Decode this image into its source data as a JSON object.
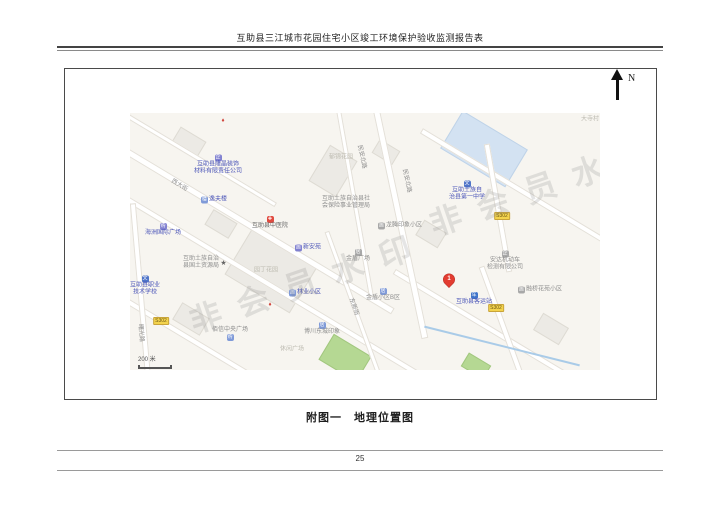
{
  "page": {
    "header_title": "互助县三江城市花园住宅小区竣工环境保护验收监测报告表",
    "caption": "附图一　地理位置图",
    "page_number": "25"
  },
  "compass": {
    "label": "N"
  },
  "map": {
    "watermark_text": "非会员水印",
    "watermarks": [
      {
        "x": 60,
        "y": 185,
        "rot": -19
      },
      {
        "x": 300,
        "y": 88,
        "rot": -19
      }
    ],
    "scale_label": "200 米",
    "scale": {
      "x": 8,
      "y": 244
    },
    "colors": {
      "map_bg": "#f7f5f0",
      "poi_blue": "#4b55b8",
      "label_gray": "#8e8e8e",
      "label_light": "#bdbbb1",
      "badge_yellow": "#f3d34d",
      "marker_red": "#e23c31",
      "school_fill": "#d3e2f2",
      "park_fill": "#b5d893"
    },
    "marker": {
      "number": "1",
      "x": 319,
      "y": 172
    },
    "badges": [
      {
        "text": "S302",
        "x": 31,
        "y": 208
      },
      {
        "text": "S302",
        "x": 372,
        "y": 103
      },
      {
        "text": "S302",
        "x": 366,
        "y": 195
      }
    ],
    "roads": [
      {
        "x": 100,
        "y": 100,
        "len": 380,
        "w": 7,
        "a": 31
      },
      {
        "x": 170,
        "y": 190,
        "len": 460,
        "w": 6,
        "a": 31
      },
      {
        "x": 150,
        "y": 280,
        "len": 380,
        "w": 6,
        "a": 31
      },
      {
        "x": 420,
        "y": 95,
        "len": 300,
        "w": 6,
        "a": 31
      },
      {
        "x": 380,
        "y": 228,
        "len": 270,
        "w": 6,
        "a": 31
      },
      {
        "x": 60,
        "y": 40,
        "len": 200,
        "w": 5,
        "a": 31
      },
      {
        "x": 270,
        "y": 110,
        "len": 235,
        "w": 7,
        "a": 78
      },
      {
        "x": 225,
        "y": 90,
        "len": 190,
        "w": 5,
        "a": 80
      },
      {
        "x": 368,
        "y": 95,
        "len": 130,
        "w": 6,
        "a": 80
      },
      {
        "x": 372,
        "y": 210,
        "len": 120,
        "w": 6,
        "a": 70
      },
      {
        "x": 12,
        "y": 195,
        "len": 210,
        "w": 6,
        "a": 85
      },
      {
        "x": 228,
        "y": 205,
        "len": 185,
        "w": 5,
        "a": 70
      }
    ],
    "river": {
      "x": 372,
      "y": 233,
      "len": 160,
      "w": 2,
      "a": 14
    },
    "buildings": [
      {
        "x": 141,
        "y": 155,
        "w": 74,
        "h": 56,
        "a": 31,
        "type": "block"
      },
      {
        "x": 202,
        "y": 57,
        "w": 30,
        "h": 40,
        "a": 31,
        "type": "block"
      },
      {
        "x": 58,
        "y": 28,
        "w": 28,
        "h": 16,
        "a": 31,
        "type": "block"
      },
      {
        "x": 255,
        "y": 38,
        "w": 22,
        "h": 14,
        "a": 31,
        "type": "block"
      },
      {
        "x": 60,
        "y": 205,
        "w": 30,
        "h": 18,
        "a": 31,
        "type": "block"
      },
      {
        "x": 300,
        "y": 120,
        "w": 24,
        "h": 16,
        "a": 31,
        "type": "block"
      },
      {
        "x": 420,
        "y": 215,
        "w": 28,
        "h": 18,
        "a": 31,
        "type": "block"
      },
      {
        "x": 90,
        "y": 110,
        "w": 26,
        "h": 16,
        "a": 31,
        "type": "block"
      },
      {
        "x": 353,
        "y": 35,
        "w": 74,
        "h": 42,
        "a": 31,
        "type": "school"
      },
      {
        "x": 214,
        "y": 244,
        "w": 42,
        "h": 28,
        "a": 31,
        "type": "park"
      },
      {
        "x": 345,
        "y": 252,
        "w": 24,
        "h": 14,
        "a": 31,
        "type": "park"
      }
    ],
    "pois": [
      {
        "name": "label-longjing-company",
        "lines": [
          "互助县隆晶装饰",
          "材料有限责任公司"
        ],
        "x": 88,
        "y": 52,
        "color": "blue",
        "icon": {
          "name": "company-icon",
          "glyph": "企",
          "bg": "#8080d0",
          "pos": "above"
        }
      },
      {
        "name": "label-yifulou",
        "lines": [
          "逸夫楼"
        ],
        "x": 84,
        "y": 87,
        "color": "blue",
        "icon": {
          "name": "building-icon",
          "glyph": "楼",
          "bg": "#7f9ad8",
          "pos": "left"
        }
      },
      {
        "name": "label-haizhou-plaza",
        "lines": [
          "海洲国际广场"
        ],
        "x": 33,
        "y": 117,
        "color": "blue",
        "icon": {
          "name": "shopping-icon",
          "glyph": "购",
          "bg": "#8080d0",
          "pos": "above"
        }
      },
      {
        "name": "label-vocational-school",
        "lines": [
          "互助县职业",
          "技术学校"
        ],
        "x": 15,
        "y": 173,
        "color": "blue",
        "icon": {
          "name": "school-icon",
          "glyph": "文",
          "bg": "#4f74c8",
          "pos": "above"
        }
      },
      {
        "name": "label-tcm-hospital",
        "lines": [
          "互助县中医院"
        ],
        "x": 140,
        "y": 110,
        "color": "dark",
        "icon": {
          "name": "hospital-cross-icon",
          "glyph": "✚",
          "bg": "#e04a3f",
          "pos": "above"
        }
      },
      {
        "name": "label-xinanyuan",
        "lines": [
          "新安苑"
        ],
        "x": 178,
        "y": 135,
        "color": "blue",
        "icon": {
          "name": "residence-icon",
          "glyph": "居",
          "bg": "#8080d0",
          "pos": "left"
        }
      },
      {
        "name": "label-land-resources-bureau",
        "lines": [
          "互助土族自治",
          "县国土资源局"
        ],
        "x": 75,
        "y": 150,
        "color": "gray",
        "icon": {
          "name": "star-icon",
          "glyph": "★",
          "bg": "transparent",
          "fg": "#666666",
          "pos": "right"
        }
      },
      {
        "name": "label-yuanding-garden",
        "lines": [
          "园丁花园"
        ],
        "x": 136,
        "y": 158,
        "color": "light"
      },
      {
        "name": "label-linye-community",
        "lines": [
          "林业小区"
        ],
        "x": 175,
        "y": 180,
        "color": "blue",
        "icon": {
          "name": "residence-icon",
          "glyph": "居",
          "bg": "#7f9ad8",
          "pos": "left"
        }
      },
      {
        "name": "label-social-insurance-bureau",
        "lines": [
          "互助土族自治县社",
          "会保险事业管理局"
        ],
        "x": 216,
        "y": 90,
        "color": "gray"
      },
      {
        "name": "label-no1-middle-school",
        "lines": [
          "互助土族自",
          "治县第一中学"
        ],
        "x": 337,
        "y": 78,
        "color": "blue",
        "icon": {
          "name": "school-icon",
          "glyph": "文",
          "bg": "#4f74c8",
          "pos": "above"
        }
      },
      {
        "name": "label-longteng-community",
        "lines": [
          "龙腾印象小区"
        ],
        "x": 270,
        "y": 113,
        "color": "gray",
        "icon": {
          "name": "residence-icon",
          "glyph": "居",
          "bg": "#a8a8a8",
          "pos": "left"
        }
      },
      {
        "name": "label-anda-vehicle-inspection",
        "lines": [
          "安达机动车",
          "检测有限公司"
        ],
        "x": 375,
        "y": 148,
        "color": "gray",
        "icon": {
          "name": "company-icon",
          "glyph": "企",
          "bg": "#a8a8a8",
          "pos": "above"
        }
      },
      {
        "name": "label-bus-station",
        "lines": [
          "互助县客运站"
        ],
        "x": 344,
        "y": 186,
        "color": "blue",
        "icon": {
          "name": "bus-icon",
          "glyph": "车",
          "bg": "#3f74c9",
          "pos": "above"
        }
      },
      {
        "name": "label-rongqiao-community",
        "lines": [
          "融桥花苑小区"
        ],
        "x": 410,
        "y": 177,
        "color": "gray",
        "icon": {
          "name": "residence-icon",
          "glyph": "居",
          "bg": "#a8a8a8",
          "pos": "left"
        }
      },
      {
        "name": "label-jindun-plaza",
        "lines": [
          "金盾广场"
        ],
        "x": 228,
        "y": 143,
        "color": "gray",
        "icon": {
          "name": "residence-icon",
          "glyph": "居",
          "bg": "#a8a8a8",
          "pos": "above"
        }
      },
      {
        "name": "label-jindun-community-b",
        "lines": [
          "金盾小区B区"
        ],
        "x": 253,
        "y": 182,
        "color": "gray",
        "icon": {
          "name": "residence-icon",
          "glyph": "居",
          "bg": "#7f9ad8",
          "pos": "above"
        }
      },
      {
        "name": "label-baixin-central-plaza",
        "lines": [
          "佰信中央广场"
        ],
        "x": 100,
        "y": 221,
        "color": "gray",
        "icon": {
          "name": "shopping-icon",
          "glyph": "购",
          "bg": "#7f9ad8",
          "pos": "below"
        }
      },
      {
        "name": "label-bochuan-dongcheng",
        "lines": [
          "博川东城印象"
        ],
        "x": 192,
        "y": 216,
        "color": "gray",
        "icon": {
          "name": "residence-icon",
          "glyph": "居",
          "bg": "#7f9ad8",
          "pos": "above"
        }
      },
      {
        "name": "label-dasi-village",
        "lines": [
          "大寺村"
        ],
        "x": 460,
        "y": 7,
        "color": "light"
      },
      {
        "name": "label-yujin-garden",
        "lines": [
          "郁锦花园"
        ],
        "x": 211,
        "y": 45,
        "color": "light"
      },
      {
        "name": "label-leisure-square",
        "lines": [
          "休闲广场"
        ],
        "x": 162,
        "y": 237,
        "color": "light"
      },
      {
        "name": "road-label-minan-north-upper",
        "lines": [
          "民安北路"
        ],
        "x": 231,
        "y": 44,
        "color": "road",
        "rot": 78
      },
      {
        "name": "road-label-minan-north",
        "lines": [
          "民安北路"
        ],
        "x": 276,
        "y": 68,
        "color": "road",
        "rot": 78
      },
      {
        "name": "road-label-xidajie",
        "lines": [
          "西大街"
        ],
        "x": 49,
        "y": 73,
        "color": "road",
        "rot": 31
      },
      {
        "name": "road-label-shuguang",
        "lines": [
          "曙光路"
        ],
        "x": 10,
        "y": 220,
        "color": "road",
        "rot": 85
      },
      {
        "name": "road-label-dongxin",
        "lines": [
          "东新街"
        ],
        "x": 223,
        "y": 194,
        "color": "road",
        "rot": 70
      }
    ],
    "decor_icons": [
      {
        "name": "red-poi-icon",
        "glyph": "♦",
        "color": "#cf4038",
        "x": 93,
        "y": 8
      },
      {
        "name": "red-poi-icon",
        "glyph": "♦",
        "color": "#cf4038",
        "x": 140,
        "y": 192
      }
    ]
  }
}
